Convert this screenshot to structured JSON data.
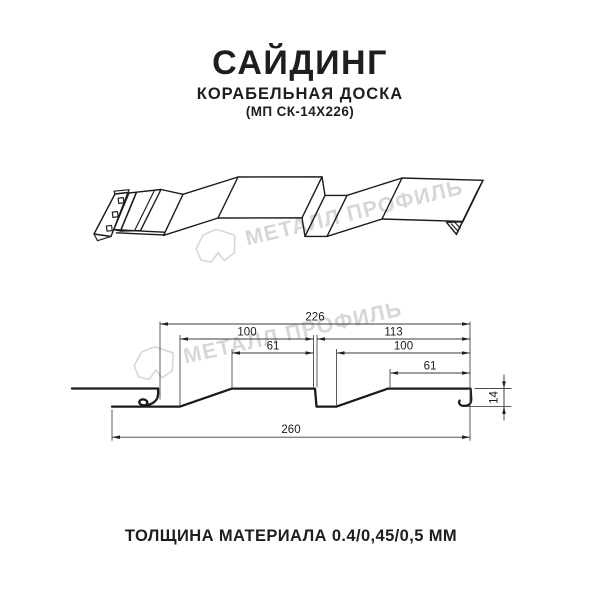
{
  "header": {
    "title": "САЙДИНГ",
    "subtitle": "КОРАБЕЛЬНАЯ ДОСКА",
    "model": "(МП СК-14Х226)"
  },
  "watermark": {
    "brand": "МЕТАЛЛ ПРОФИЛЬ",
    "color": "#d7d7d7"
  },
  "drawing": {
    "kind": "siding-profile-cross-section",
    "dimensions_mm": {
      "coverage_width": 226,
      "left_module_width": 100,
      "right_module_width": 113,
      "left_flat": 61,
      "right_flat": 100,
      "right_small_flat": 61,
      "overall_width": 260,
      "profile_height": 14
    },
    "dim_labels": {
      "coverage": "226",
      "left_module": "100",
      "right_module": "113",
      "left_flat": "61",
      "right_flat": "100",
      "right_small_flat": "61",
      "overall": "260",
      "height": "14"
    }
  },
  "footer": {
    "thickness": "ТОЛЩИНА МАТЕРИАЛА 0.4/0,45/0,5 ММ"
  }
}
